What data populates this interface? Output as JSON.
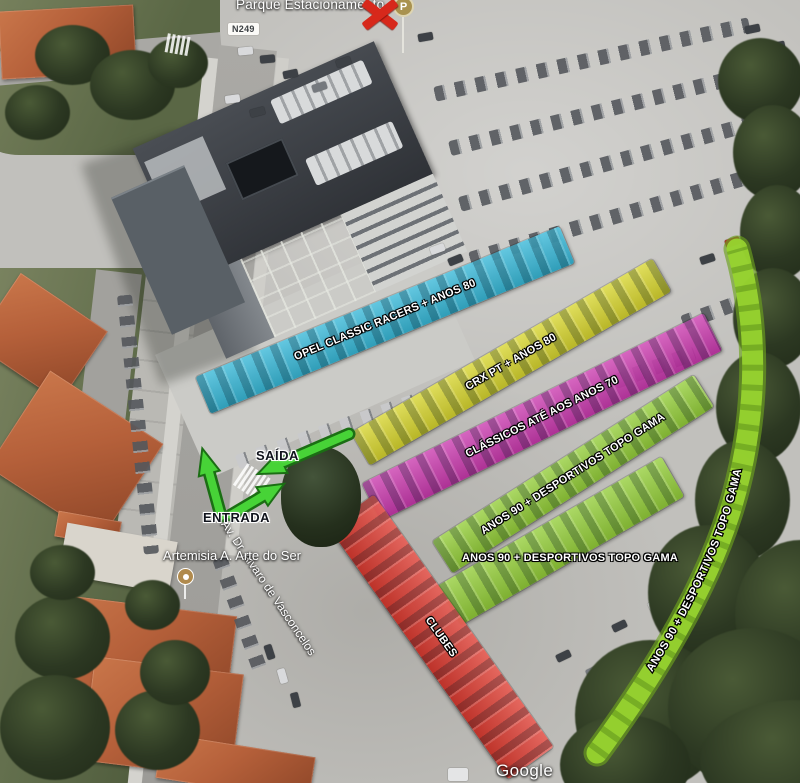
{
  "map": {
    "parking_label": "Parque Estacionamento",
    "parking_marker": "P",
    "road_shield": "N249",
    "poi_label": "Artemisia A. Arte do Ser",
    "street_label": "Av. Dr. Álvaro de Vasconcelos",
    "watermark": "Google"
  },
  "flow": {
    "exit_label": "SAÍDA",
    "entrance_label": "ENTRADA"
  },
  "zones": [
    {
      "id": "opel",
      "label": "OPEL CLASSIC RACERS + ANOS 80",
      "color": "#2ab5d8"
    },
    {
      "id": "crx",
      "label": "CRX PT + ANOS 80",
      "color": "#d8d622"
    },
    {
      "id": "classicos",
      "label": "CLÁSSICOS ATÉ AOS ANOS 70",
      "color": "#ca2fad"
    },
    {
      "id": "anos90_row1",
      "label": "ANOS 90 + DESPORTIVOS TOPO GAMA",
      "color": "#8fce2e"
    },
    {
      "id": "anos90_row2",
      "label": "ANOS 90 + DESPORTIVOS TOPO GAMA",
      "color": "#8fce2e"
    },
    {
      "id": "anos90_curve",
      "label": "ANOS 90 + DESPORTIVOS TOPO GAMA",
      "color": "#8fce2e"
    },
    {
      "id": "clubes",
      "label": "CLUBES",
      "color": "#df3126"
    }
  ],
  "colors": {
    "zone_cyan": "#2ab5d8",
    "zone_yellow": "#d8d622",
    "zone_magenta": "#ca2fad",
    "zone_green": "#8fce2e",
    "zone_red": "#df3126",
    "arrow_green": "#47d337",
    "crossout_red": "#d7281b"
  }
}
